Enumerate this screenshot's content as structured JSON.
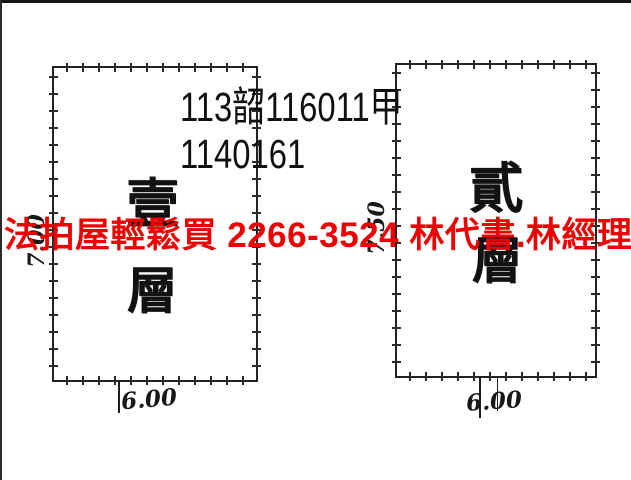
{
  "scan": {
    "ink_color": "#1a1a1a",
    "case_number_line1": "113韶116011甲",
    "case_number_line2": "1140161"
  },
  "ad_overlay": {
    "text": "法拍屋輕鬆買  2266-3524  林代書.林經理",
    "color": "#ee0000"
  },
  "plans": [
    {
      "title": "first-floor-plan",
      "char_top": "壹",
      "char_bottom": "層",
      "side_dim": "7.00",
      "bottom_dim": "6.00"
    },
    {
      "title": "second-floor-plan",
      "char_top": "貳",
      "char_bottom": "層",
      "side_dim": "7.50",
      "bottom_dim": "6.00"
    }
  ]
}
